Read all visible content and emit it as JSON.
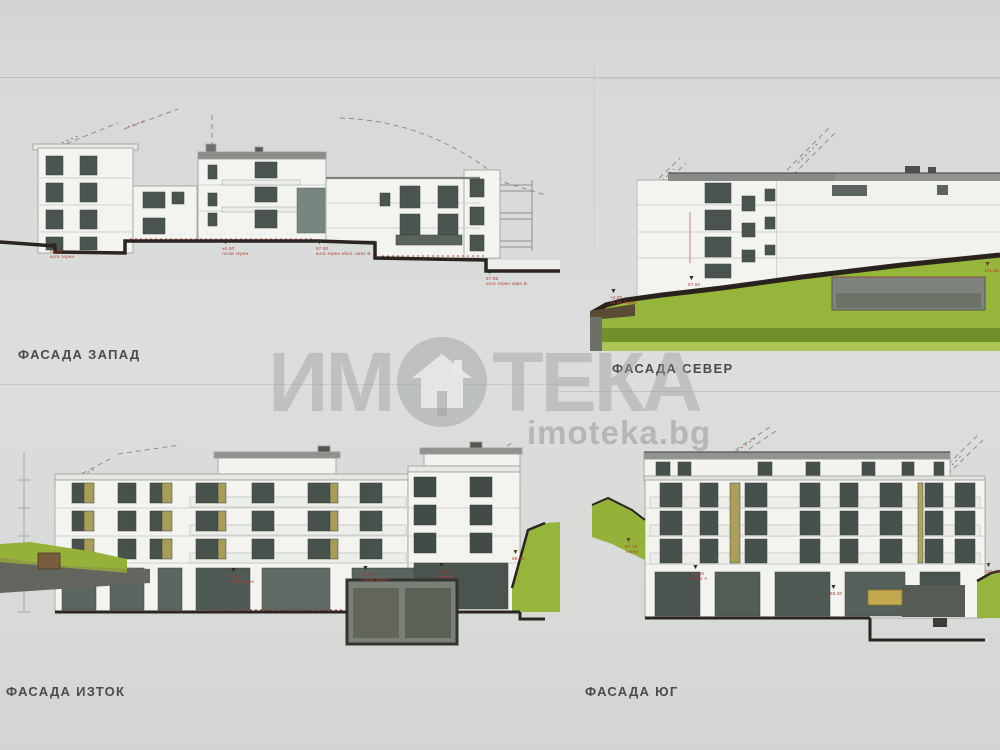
{
  "watermark": {
    "brand_left": "ИМ",
    "brand_right": "ТЕКА",
    "domain": "imoteka.bg"
  },
  "icons": {
    "level_marker": "▼"
  },
  "colors": {
    "paper": "#d9dbd9",
    "wall_white": "#f3f3f0",
    "window_dark": "#4a554f",
    "olive_panel": "#a89c58",
    "terrain_green": "#96b53b",
    "terrain_dark_band": "#70902c",
    "ground_line": "#2b2420",
    "annotation_red": "#b23b2f"
  },
  "facades": {
    "west": {
      "label": "ФАСАДА ЗАПАД",
      "markers": [
        {
          "line1": "96.05",
          "line2": "кота терен"
        },
        {
          "line1": "±0.00",
          "line2": "готов терен"
        },
        {
          "line1": "97.00",
          "line2": "кота терен обсл. ниво В"
        },
        {
          "line1": "97.05",
          "line2": "кота терен ниво В"
        }
      ]
    },
    "north": {
      "label": "ФАСАДА СЕВЕР",
      "markers": [
        {
          "line1": "+2.80",
          "line2": "96.05 терен"
        },
        {
          "line1": "97.60",
          "line2": ""
        },
        {
          "line1": "101.30",
          "line2": ""
        }
      ]
    },
    "east": {
      "label": "ФАСАДА ИЗТОК",
      "markers": [
        {
          "line1": "96.30",
          "line2": "кота терен"
        },
        {
          "line1": "±0.00",
          "line2": "готов терен"
        },
        {
          "line1": "95.80",
          "line2": "ниво Б"
        },
        {
          "line1": "98.40",
          "line2": ""
        }
      ]
    },
    "south": {
      "label": "ФАСАДА ЮГ",
      "markers": [
        {
          "line1": "96.60",
          "line2": "ниво А"
        },
        {
          "line1": "95.20",
          "line2": ""
        },
        {
          "line1": "101.30",
          "line2": ""
        },
        {
          "line1": "97.19",
          "line2": "терен"
        }
      ]
    }
  }
}
